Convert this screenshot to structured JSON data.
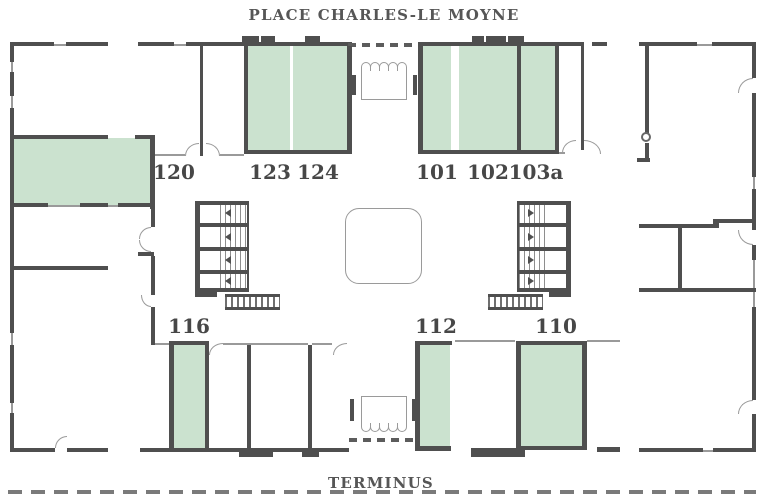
{
  "titles": {
    "top": "PLACE CHARLES-LE MOYNE",
    "bottom": "TERMINUS"
  },
  "rooms": [
    {
      "id": "120",
      "label": "120",
      "highlighted": true
    },
    {
      "id": "123",
      "label": "123",
      "highlighted": true
    },
    {
      "id": "124",
      "label": "124",
      "highlighted": true
    },
    {
      "id": "101",
      "label": "101",
      "highlighted": true
    },
    {
      "id": "102",
      "label": "102",
      "highlighted": true
    },
    {
      "id": "103a",
      "label": "103a",
      "highlighted": true
    },
    {
      "id": "116",
      "label": "116",
      "highlighted": true
    },
    {
      "id": "112",
      "label": "112",
      "highlighted": true
    },
    {
      "id": "110",
      "label": "110",
      "highlighted": true
    }
  ],
  "icons": {
    "stair_direction_left": "◀",
    "stair_direction_right": "▶"
  },
  "colors": {
    "wall": "#4f4f4f",
    "thin_line": "#9a9a9a",
    "highlight_fill": "#cbe2cf",
    "label_text": "#474747"
  }
}
